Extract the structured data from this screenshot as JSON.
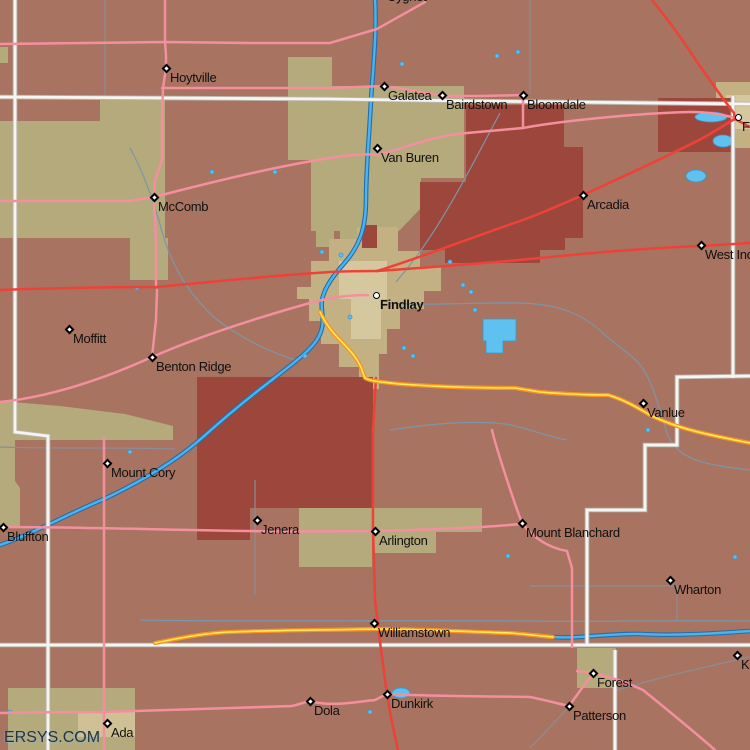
{
  "watermark": "ERSYS.COM",
  "palette": {
    "land": "#a87361",
    "khaki": "#b4aa7c",
    "khaki_light": "#cfc096",
    "city_tan": "#c3b184",
    "city_tan_light": "#d6c89e",
    "dark_red": "#9d473c",
    "water_fill": "#5ec1f0",
    "water_edge": "#3a97cf",
    "river_core": "#4fb3ea",
    "river_casing": "#1f6fae",
    "stream": "#7d95a8",
    "boundary_gray": "#8d8d95",
    "road_pink": "#f48fa0",
    "road_red": "#ee4238",
    "road_orange": "#f7941d",
    "road_orange_core": "#ffe85e",
    "road_white_core": "#f7f5f1",
    "road_white_casing": "#b9b6b0",
    "label": "#101010",
    "marker": "#000000"
  },
  "towns": [
    {
      "name": "Cygnet",
      "marker": "none",
      "x": 383,
      "y": -13
    },
    {
      "name": "Hoytville",
      "marker": "diamond",
      "x": 166,
      "y": 68
    },
    {
      "name": "Galatea",
      "marker": "diamond",
      "x": 384,
      "y": 86
    },
    {
      "name": "Bairdstown",
      "marker": "diamond",
      "x": 442,
      "y": 95
    },
    {
      "name": "Bloomdale",
      "marker": "diamond",
      "x": 523,
      "y": 95
    },
    {
      "name": "Van Buren",
      "marker": "diamond",
      "x": 377,
      "y": 148
    },
    {
      "name": "McComb",
      "marker": "diamond",
      "x": 154,
      "y": 197
    },
    {
      "name": "Arcadia",
      "marker": "diamond",
      "x": 583,
      "y": 195
    },
    {
      "name": "Fostoria",
      "marker": "circle",
      "x": 738,
      "y": 117
    },
    {
      "name": "West Independence",
      "marker": "diamond",
      "x": 701,
      "y": 245
    },
    {
      "name": "Findlay",
      "marker": "circle",
      "x": 376,
      "y": 295,
      "bold": true
    },
    {
      "name": "Moffitt",
      "marker": "diamond",
      "x": 69,
      "y": 329
    },
    {
      "name": "Benton Ridge",
      "marker": "diamond",
      "x": 152,
      "y": 357
    },
    {
      "name": "Mount Cory",
      "marker": "diamond",
      "x": 107,
      "y": 463
    },
    {
      "name": "Bluffton",
      "marker": "diamond",
      "x": 3,
      "y": 527
    },
    {
      "name": "Jenera",
      "marker": "diamond",
      "x": 257,
      "y": 520
    },
    {
      "name": "Arlington",
      "marker": "diamond",
      "x": 375,
      "y": 531
    },
    {
      "name": "Mount Blanchard",
      "marker": "diamond",
      "x": 522,
      "y": 523
    },
    {
      "name": "Vanlue",
      "marker": "diamond",
      "x": 643,
      "y": 403
    },
    {
      "name": "Wharton",
      "marker": "diamond",
      "x": 670,
      "y": 580
    },
    {
      "name": "Williamstown",
      "marker": "diamond",
      "x": 374,
      "y": 623
    },
    {
      "name": "Dunkirk",
      "marker": "diamond",
      "x": 387,
      "y": 694
    },
    {
      "name": "Dola",
      "marker": "diamond",
      "x": 310,
      "y": 701
    },
    {
      "name": "Forest",
      "marker": "diamond",
      "x": 593,
      "y": 673
    },
    {
      "name": "Patterson",
      "marker": "diamond",
      "x": 569,
      "y": 706
    },
    {
      "name": "Kirby",
      "marker": "diamond",
      "x": 737,
      "y": 655
    },
    {
      "name": "Ada",
      "marker": "diamond",
      "x": 107,
      "y": 723
    }
  ]
}
